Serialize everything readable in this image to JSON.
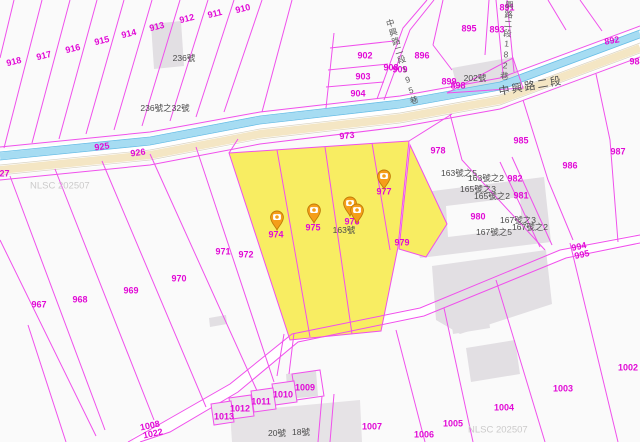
{
  "map": {
    "watermark": {
      "text": "NLSC 202507",
      "positions": [
        [
          30,
          186
        ],
        [
          468,
          430
        ]
      ]
    },
    "roads": {
      "main": {
        "text": "中興路二段"
      },
      "lane182": {
        "text": "中興路二段182巷"
      },
      "lane195": {
        "text": "中興路二段195巷"
      }
    },
    "parcels": [
      {
        "t": "918",
        "x": 14,
        "y": 62,
        "a": -14
      },
      {
        "t": "917",
        "x": 44,
        "y": 56,
        "a": -14
      },
      {
        "t": "916",
        "x": 73,
        "y": 49,
        "a": -14
      },
      {
        "t": "915",
        "x": 102,
        "y": 41,
        "a": -14
      },
      {
        "t": "914",
        "x": 129,
        "y": 34,
        "a": -14
      },
      {
        "t": "913",
        "x": 157,
        "y": 27,
        "a": -14
      },
      {
        "t": "912",
        "x": 187,
        "y": 19,
        "a": -14
      },
      {
        "t": "911",
        "x": 215,
        "y": 14,
        "a": -14
      },
      {
        "t": "910",
        "x": 243,
        "y": 9,
        "a": -14
      },
      {
        "t": "927",
        "x": 2,
        "y": 174,
        "a": 0
      },
      {
        "t": "902",
        "x": 365,
        "y": 56,
        "a": 0
      },
      {
        "t": "903",
        "x": 363,
        "y": 77,
        "a": 0
      },
      {
        "t": "904",
        "x": 358,
        "y": 94,
        "a": 0
      },
      {
        "t": "908",
        "x": 391,
        "y": 68,
        "a": 0
      },
      {
        "t": "909",
        "x": 400,
        "y": 70,
        "a": 0
      },
      {
        "t": "896",
        "x": 422,
        "y": 56,
        "a": 0
      },
      {
        "t": "895",
        "x": 469,
        "y": 29,
        "a": 0
      },
      {
        "t": "891",
        "x": 507,
        "y": 8,
        "a": 0
      },
      {
        "t": "893",
        "x": 497,
        "y": 30,
        "a": 0
      },
      {
        "t": "892",
        "x": 612,
        "y": 41,
        "a": -10
      },
      {
        "t": "988",
        "x": 637,
        "y": 62,
        "a": 0
      },
      {
        "t": "899",
        "x": 449,
        "y": 82,
        "a": 0
      },
      {
        "t": "898",
        "x": 458,
        "y": 86,
        "a": 0
      },
      {
        "t": "925",
        "x": 102,
        "y": 147,
        "a": -8
      },
      {
        "t": "926",
        "x": 138,
        "y": 153,
        "a": -8
      },
      {
        "t": "973",
        "x": 347,
        "y": 136,
        "a": -6
      },
      {
        "t": "978",
        "x": 438,
        "y": 151,
        "a": 0
      },
      {
        "t": "985",
        "x": 521,
        "y": 141,
        "a": 0
      },
      {
        "t": "986",
        "x": 570,
        "y": 166,
        "a": 0
      },
      {
        "t": "987",
        "x": 618,
        "y": 152,
        "a": 0
      },
      {
        "t": "982",
        "x": 515,
        "y": 179,
        "a": 0
      },
      {
        "t": "981",
        "x": 521,
        "y": 196,
        "a": 0
      },
      {
        "t": "980",
        "x": 478,
        "y": 217,
        "a": 0
      },
      {
        "t": "979",
        "x": 402,
        "y": 243,
        "a": 0
      },
      {
        "t": "977",
        "x": 384,
        "y": 192,
        "a": 0
      },
      {
        "t": "976",
        "x": 352,
        "y": 222,
        "a": 0
      },
      {
        "t": "975",
        "x": 313,
        "y": 228,
        "a": 0
      },
      {
        "t": "974",
        "x": 276,
        "y": 235,
        "a": 0
      },
      {
        "t": "972",
        "x": 246,
        "y": 255,
        "a": 0
      },
      {
        "t": "971",
        "x": 223,
        "y": 252,
        "a": 0
      },
      {
        "t": "970",
        "x": 179,
        "y": 279,
        "a": 0
      },
      {
        "t": "969",
        "x": 131,
        "y": 291,
        "a": 0
      },
      {
        "t": "968",
        "x": 80,
        "y": 300,
        "a": 0
      },
      {
        "t": "967",
        "x": 39,
        "y": 305,
        "a": 0
      },
      {
        "t": "994",
        "x": 579,
        "y": 247,
        "a": -12
      },
      {
        "t": "995",
        "x": 582,
        "y": 255,
        "a": -12
      },
      {
        "t": "1008",
        "x": 150,
        "y": 426,
        "a": -12
      },
      {
        "t": "1022",
        "x": 153,
        "y": 434,
        "a": -12
      },
      {
        "t": "1013",
        "x": 224,
        "y": 417,
        "a": 0
      },
      {
        "t": "1012",
        "x": 240,
        "y": 409,
        "a": 0
      },
      {
        "t": "1011",
        "x": 261,
        "y": 402,
        "a": 0
      },
      {
        "t": "1010",
        "x": 283,
        "y": 395,
        "a": 0
      },
      {
        "t": "1009",
        "x": 305,
        "y": 388,
        "a": 0
      },
      {
        "t": "1007",
        "x": 372,
        "y": 427,
        "a": 0
      },
      {
        "t": "1006",
        "x": 424,
        "y": 435,
        "a": 0
      },
      {
        "t": "1005",
        "x": 453,
        "y": 424,
        "a": 0
      },
      {
        "t": "1004",
        "x": 504,
        "y": 408,
        "a": 0
      },
      {
        "t": "1003",
        "x": 563,
        "y": 389,
        "a": 0
      },
      {
        "t": "1002",
        "x": 628,
        "y": 368,
        "a": 0
      }
    ],
    "addresses": [
      {
        "t": "236號",
        "x": 184,
        "y": 58
      },
      {
        "t": "236號之32號",
        "x": 165,
        "y": 108
      },
      {
        "t": "202號",
        "x": 475,
        "y": 78
      },
      {
        "t": "163號之5",
        "x": 459,
        "y": 173
      },
      {
        "t": "163號之2",
        "x": 486,
        "y": 178
      },
      {
        "t": "165號之3",
        "x": 478,
        "y": 189
      },
      {
        "t": "165號之2",
        "x": 492,
        "y": 196
      },
      {
        "t": "167號之3",
        "x": 518,
        "y": 220
      },
      {
        "t": "167號之2",
        "x": 530,
        "y": 227
      },
      {
        "t": "167號之5",
        "x": 494,
        "y": 232
      },
      {
        "t": "163號",
        "x": 344,
        "y": 230
      },
      {
        "t": "20號",
        "x": 277,
        "y": 433
      },
      {
        "t": "18號",
        "x": 301,
        "y": 432
      }
    ],
    "markers": {
      "positions": [
        [
          277,
          230
        ],
        [
          314,
          223
        ],
        [
          350,
          216
        ],
        [
          357,
          223
        ],
        [
          384,
          189
        ]
      ]
    },
    "colors": {
      "parcel_line": "#f050ec",
      "parcel_label": "#e10ad6",
      "highlight_fill": "#f8ed62",
      "stream_fill": "#a6dcf2",
      "stream_edge": "#64bce6",
      "road_fill": "#f4e6c4",
      "building_fill": "#e2dfe3",
      "address_text": "#4a4a4a",
      "watermark": "#cbcaca",
      "marker": "#f59e19"
    }
  }
}
